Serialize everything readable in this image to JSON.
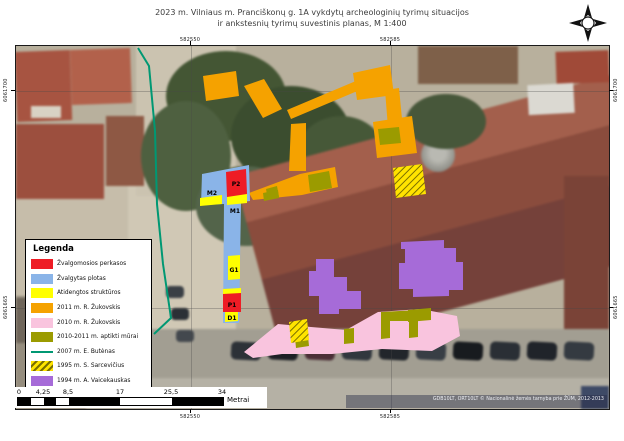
{
  "title": {
    "line1": "2023 m. Vilniaus m. Pranciškonų g. 1A vykdytų archeologinių tyrimų situacijos",
    "line2": "ir ankstesnių tyrimų suvestinis planas, M 1:400"
  },
  "grid": {
    "x_left": "582550",
    "x_right": "582585",
    "y_top": "6061700",
    "y_bottom": "6061665"
  },
  "map_labels": {
    "p2": "P2",
    "m2": "M2",
    "m1": "M1",
    "g1": "G1",
    "p1": "P1",
    "d1": "D1"
  },
  "attribution": "GDB10LT, ORT10LT © Nacionalinė žemės tarnyba prie ŽŪM, 2012-2013",
  "legend": {
    "title": "Legenda",
    "items": [
      {
        "label": "Žvalgomosios perkasos",
        "swatch": "red"
      },
      {
        "label": "Žvalgytas plotas",
        "swatch": "blue"
      },
      {
        "label": "Atidengtos struktūros",
        "swatch": "yellow"
      },
      {
        "label": "2011 m. R. Žukovskis",
        "swatch": "orange"
      },
      {
        "label": "2010 m. R. Žukovskis",
        "swatch": "pink"
      },
      {
        "label": "2010-2011 m. aptikti mūrai",
        "swatch": "olive"
      },
      {
        "label": "2007 m. E. Butėnas",
        "swatch": "teal-line"
      },
      {
        "label": "1995 m. S. Sarcevičius",
        "swatch": "hatch"
      },
      {
        "label": "1994 m. A. Vaicekauskas",
        "swatch": "purple"
      }
    ]
  },
  "scalebar": {
    "ticks": [
      "0",
      "4,25",
      "8,5",
      "17",
      "25,5",
      "34"
    ],
    "unit": "Metrai"
  },
  "colors": {
    "red": "#ee1c25",
    "blue": "#8ab4e8",
    "yellow": "#ffff00",
    "orange": "#f5a200",
    "pink": "#f9c4de",
    "olive": "#9b9b00",
    "teal": "#009873",
    "purple": "#a66bd8",
    "hatch-yellow": "#ffe400",
    "hatch-dark": "#7a6f00"
  }
}
